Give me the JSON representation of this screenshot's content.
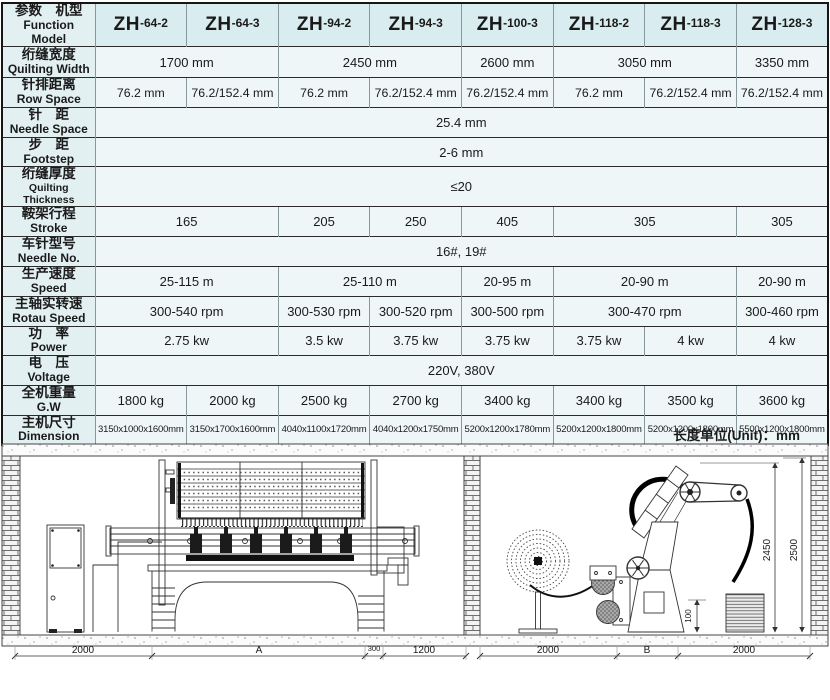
{
  "table": {
    "header": {
      "label_cn": "参数　机型",
      "label_en": "Function Model",
      "models": [
        {
          "p": "ZH",
          "s": "-64-2"
        },
        {
          "p": "ZH",
          "s": "-64-3"
        },
        {
          "p": "ZH",
          "s": "-94-2"
        },
        {
          "p": "ZH",
          "s": "-94-3"
        },
        {
          "p": "ZH",
          "s": "-100-3"
        },
        {
          "p": "ZH",
          "s": "-118-2"
        },
        {
          "p": "ZH",
          "s": "-118-3"
        },
        {
          "p": "ZH",
          "s": "-128-3"
        }
      ]
    },
    "rows": [
      {
        "cn": "绗缝宽度",
        "en": "Quilting Width",
        "cells": [
          {
            "t": "1700 mm",
            "span": 2
          },
          {
            "t": "2450 mm",
            "span": 2
          },
          {
            "t": "2600 mm",
            "span": 1
          },
          {
            "t": "3050 mm",
            "span": 2
          },
          {
            "t": "3350 mm",
            "span": 1
          }
        ]
      },
      {
        "cn": "针排距离",
        "en": "Row Space",
        "cells": [
          {
            "t": "76.2 mm",
            "span": 1
          },
          {
            "t": "76.2/152.4 mm",
            "span": 1
          },
          {
            "t": "76.2 mm",
            "span": 1
          },
          {
            "t": "76.2/152.4 mm",
            "span": 1
          },
          {
            "t": "76.2/152.4 mm",
            "span": 1
          },
          {
            "t": "76.2 mm",
            "span": 1
          },
          {
            "t": "76.2/152.4 mm",
            "span": 1
          },
          {
            "t": "76.2/152.4 mm",
            "span": 1
          }
        ]
      },
      {
        "cn": "针　距",
        "en": "Needle Space",
        "cells": [
          {
            "t": "25.4 mm",
            "span": 8
          }
        ]
      },
      {
        "cn": "步　距",
        "en": "Footstep",
        "cells": [
          {
            "t": "2-6 mm",
            "span": 8
          }
        ]
      },
      {
        "cn": "绗缝厚度",
        "en": "Quilting Thickness",
        "cells": [
          {
            "t": "≤20",
            "span": 8
          }
        ]
      },
      {
        "cn": "鞍架行程",
        "en": "Stroke",
        "cells": [
          {
            "t": "165",
            "span": 2
          },
          {
            "t": "205",
            "span": 1
          },
          {
            "t": "250",
            "span": 1
          },
          {
            "t": "405",
            "span": 1
          },
          {
            "t": "305",
            "span": 2
          },
          {
            "t": "305",
            "span": 1
          }
        ]
      },
      {
        "cn": "车针型号",
        "en": "Needle No.",
        "cells": [
          {
            "t": "16#, 19#",
            "span": 8
          }
        ]
      },
      {
        "cn": "生产速度",
        "en": "Speed",
        "cells": [
          {
            "t": "25-115 m",
            "span": 2
          },
          {
            "t": "25-110 m",
            "span": 2
          },
          {
            "t": "20-95 m",
            "span": 1
          },
          {
            "t": "20-90 m",
            "span": 2
          },
          {
            "t": "20-90 m",
            "span": 1
          }
        ]
      },
      {
        "cn": "主轴实转速",
        "en": "Rotau Speed",
        "cells": [
          {
            "t": "300-540 rpm",
            "span": 2
          },
          {
            "t": "300-530 rpm",
            "span": 1
          },
          {
            "t": "300-520 rpm",
            "span": 1
          },
          {
            "t": "300-500 rpm",
            "span": 1
          },
          {
            "t": "300-470 rpm",
            "span": 2
          },
          {
            "t": "300-460 rpm",
            "span": 1
          }
        ]
      },
      {
        "cn": "功　率",
        "en": "Power",
        "cells": [
          {
            "t": "2.75 kw",
            "span": 2
          },
          {
            "t": "3.5 kw",
            "span": 1
          },
          {
            "t": "3.75 kw",
            "span": 1
          },
          {
            "t": "3.75 kw",
            "span": 1
          },
          {
            "t": "3.75 kw",
            "span": 1
          },
          {
            "t": "4 kw",
            "span": 1
          },
          {
            "t": "4 kw",
            "span": 1
          }
        ]
      },
      {
        "cn": "电　压",
        "en": "Voltage",
        "cells": [
          {
            "t": "220V, 380V",
            "span": 8
          }
        ]
      },
      {
        "cn": "全机重量",
        "en": "G.W",
        "cells": [
          {
            "t": "1800 kg",
            "span": 1
          },
          {
            "t": "2000 kg",
            "span": 1
          },
          {
            "t": "2500 kg",
            "span": 1
          },
          {
            "t": "2700 kg",
            "span": 1
          },
          {
            "t": "3400 kg",
            "span": 1
          },
          {
            "t": "3400 kg",
            "span": 1
          },
          {
            "t": "3500 kg",
            "span": 1
          },
          {
            "t": "3600 kg",
            "span": 1
          }
        ]
      },
      {
        "cn": "主机尺寸",
        "en": "Dimension",
        "cells": [
          {
            "t": "3150x1000x1600mm",
            "span": 1
          },
          {
            "t": "3150x1700x1600mm",
            "span": 1
          },
          {
            "t": "4040x1100x1720mm",
            "span": 1
          },
          {
            "t": "4040x1200x1750mm",
            "span": 1
          },
          {
            "t": "5200x1200x1780mm",
            "span": 1
          },
          {
            "t": "5200x1200x1800mm",
            "span": 1
          },
          {
            "t": "5200x1200x1800mm",
            "span": 1
          },
          {
            "t": "5500x1200x1800mm",
            "span": 1
          }
        ]
      }
    ]
  },
  "diagram": {
    "unit_label": "长度单位(Unit)：mm",
    "dims_bottom": [
      "2000",
      "A",
      "300",
      "1200",
      "2000",
      "B",
      "2000"
    ],
    "dims_vertical": [
      "2450",
      "2500",
      "100"
    ]
  },
  "colors": {
    "cell_bg": "#eef6f7",
    "header_bg": "#d9edf0",
    "label_bg": "#e3f0f2",
    "border_dark": "#222222"
  }
}
